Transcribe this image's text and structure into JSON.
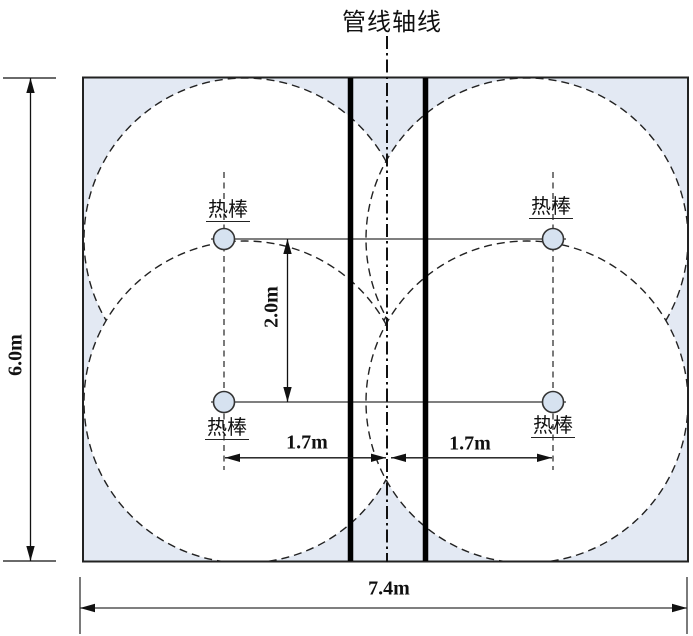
{
  "title": "管线轴线",
  "labels": {
    "thermal_rod": "热棒"
  },
  "dimensions": {
    "embankment_height": "6.0m",
    "embankment_width": "7.4m",
    "rod_vertical_spacing": "2.0m",
    "rod_offset_left_of_axis": "1.7m",
    "rod_offset_right_of_axis": "1.7m"
  },
  "colors": {
    "embankment_fill": "#e3e9f3",
    "freeze_zone_fill": "#ffffff",
    "rod_fill": "#d6e2f0",
    "line": "#1a1a1a"
  }
}
